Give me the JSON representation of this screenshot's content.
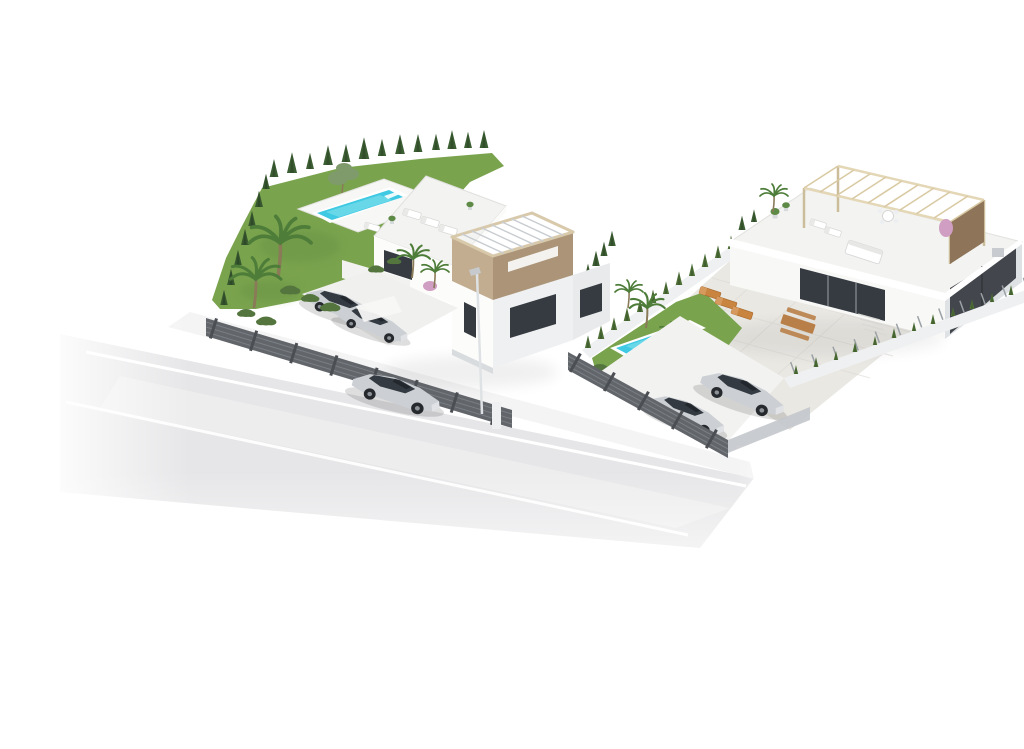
{
  "meta": {
    "type": "architectural-3d-render",
    "title": "Aerial 3D visualisation of two new-build villas",
    "alt": "Aerial isometric 3D architectural rendering of two modern white villas with private pools, landscaped gardens with palm trees and cypress hedges, dark slatted street fences, parked cars, and a silver sedan driving on the road in front, all floating on a white background."
  },
  "colors": {
    "background": "#ffffff",
    "road": "#e6e6e8",
    "road_light": "#f2f2f3",
    "road_marking": "#ffffff",
    "sidewalk": "#f4f4f5",
    "lawn": "#7aa34e",
    "lawn_shade": "#699344",
    "cypress": "#3c5e33",
    "cypress_dark": "#37572f",
    "hedge": "#4e7037",
    "palm_frond": "#4e7d3a",
    "olive_foliage": "#7f9a6b",
    "pool_water": "#3fc9e2",
    "pool_water_light": "#8ae4ee",
    "pool_rim": "#ffffff",
    "wall_lit": "#fcfcfb",
    "wall_shaded": "#e8eaec",
    "wall_boundary": "#eef0f1",
    "roof_deck": "#f3f3f1",
    "patio": "#eae8e3",
    "glass_dark": "#363b41",
    "garage_dark": "#43474d",
    "wood_beige_light": "#c2ad90",
    "wood_beige_dark": "#ab9478",
    "pergola_wood": "#e4d7b6",
    "pergola_slat": "#d9caa4",
    "pergola_slat_metal": "#c7ccd0",
    "pergola_panel": "#8e7458",
    "fence_dark": "#62666b",
    "fence_post": "#4b4f54",
    "fence_panel_light": "#c3c7cb",
    "car_silver": "#ccd0d4",
    "car_glass": "#343a41",
    "lounger_orange": "#c9853f",
    "table_wood": "#b97f48",
    "flower_pink": "#cf9ec2",
    "trunk_brown": "#8a7a58"
  },
  "scene": {
    "view": "isometric aerial on white background",
    "left_villa": {
      "label": "left-villa",
      "storeys": 2,
      "features": [
        "beige rooftop pergola box with slatted open roof",
        "white roof deck with sun loungers",
        "private rectangular pool on white terrace beside lawn",
        "garden with two palm trees, olive tree and cypress rows",
        "driveway with two parked silver cars under white canopy",
        "dark slatted street fence with posts",
        "street lamp at the kerb"
      ]
    },
    "right_villa": {
      "label": "right-villa",
      "storeys": 1,
      "features": [
        "roof terrace with light wooden pergola and brown side panel",
        "roof furniture: round table with chairs, white sofa, loungers, potted plants, pink flowering plant",
        "tiled patio with orange sun loungers and wooden picnic table",
        "lawn with rectangular pool and palm tree",
        "cypress hedge on left boundary wall and young hedge with railing on right boundary wall",
        "dark glazed opening and dark garage volume",
        "driveway with two parked silver cars behind dark slatted fence"
      ]
    },
    "road": {
      "label": "road",
      "lane_marking_lines": 2,
      "vehicles": [
        {
          "label": "silver sedan driving toward lower left"
        }
      ]
    },
    "totals": {
      "pools": 2,
      "vehicles": 5,
      "villas": 2
    }
  }
}
